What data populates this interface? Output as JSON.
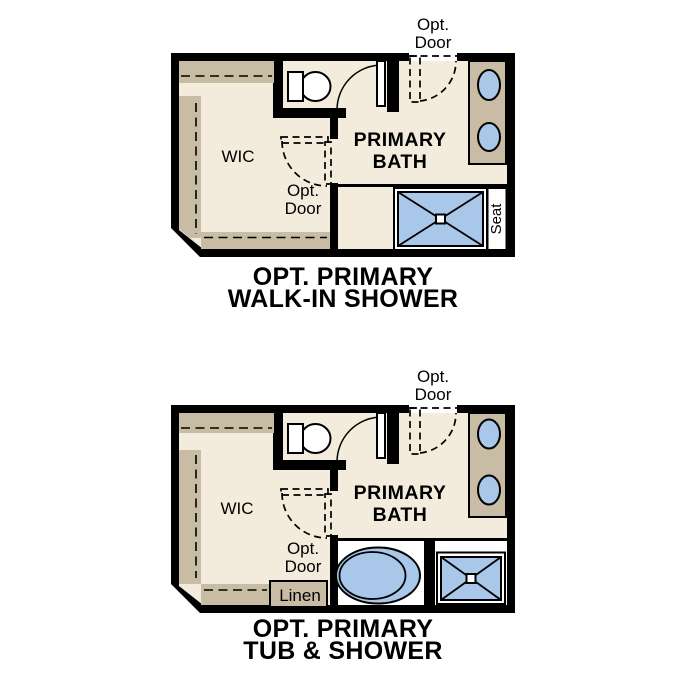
{
  "colors": {
    "wall": "#000000",
    "floor": "#f3ecdc",
    "cabinet": "#c9bca4",
    "fixture": "#a9c8e9",
    "paper": "#ffffff"
  },
  "plans": [
    {
      "name": "walk-in-shower-option",
      "caption": {
        "line1": "OPT. PRIMARY",
        "line2": "WALK-IN SHOWER"
      },
      "labels": {
        "wic": "WIC",
        "bath_line1": "PRIMARY",
        "bath_line2": "BATH",
        "opt_door_top": {
          "line1": "Opt.",
          "line2": "Door"
        },
        "opt_door_mid": {
          "line1": "Opt.",
          "line2": "Door"
        },
        "seat": "Seat"
      }
    },
    {
      "name": "tub-shower-option",
      "caption": {
        "line1": "OPT. PRIMARY",
        "line2": "TUB & SHOWER"
      },
      "labels": {
        "wic": "WIC",
        "bath_line1": "PRIMARY",
        "bath_line2": "BATH",
        "opt_door_top": {
          "line1": "Opt.",
          "line2": "Door"
        },
        "opt_door_mid": {
          "line1": "Opt.",
          "line2": "Door"
        },
        "linen": "Linen"
      }
    }
  ]
}
